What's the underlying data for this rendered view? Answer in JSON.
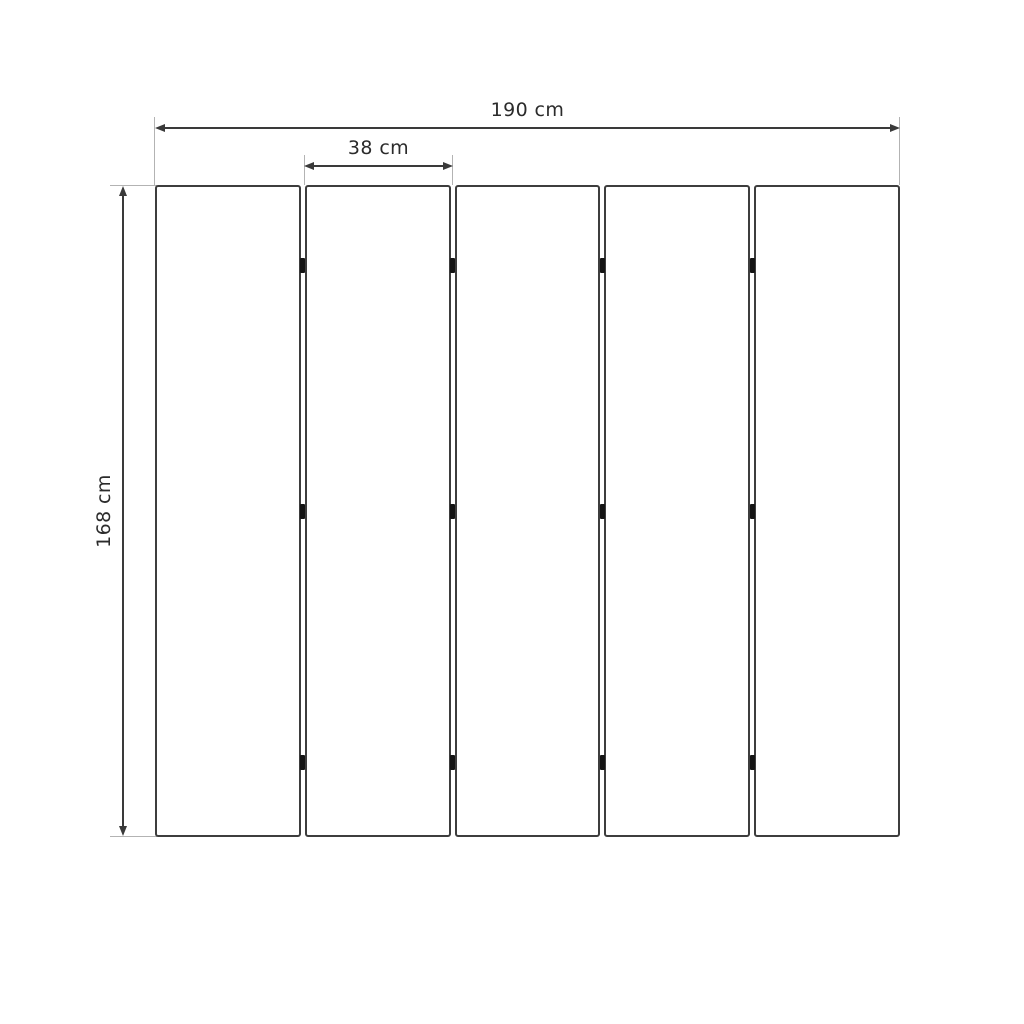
{
  "diagram": {
    "panel_count": 5,
    "hinges_per_gap": 3,
    "hinge_row_positions_pct": [
      12.3,
      50,
      88.5
    ],
    "labels": {
      "total_width": "190 cm",
      "panel_width": "38 cm",
      "height": "168 cm"
    },
    "colors": {
      "background": "#ffffff",
      "panel_fill": "#ffffff",
      "panel_border": "#3d3d3d",
      "dimension_line": "#3a3a3a",
      "extension_line": "#b3b3b3",
      "hinge": "#141414",
      "text": "#2b2b2b"
    }
  }
}
